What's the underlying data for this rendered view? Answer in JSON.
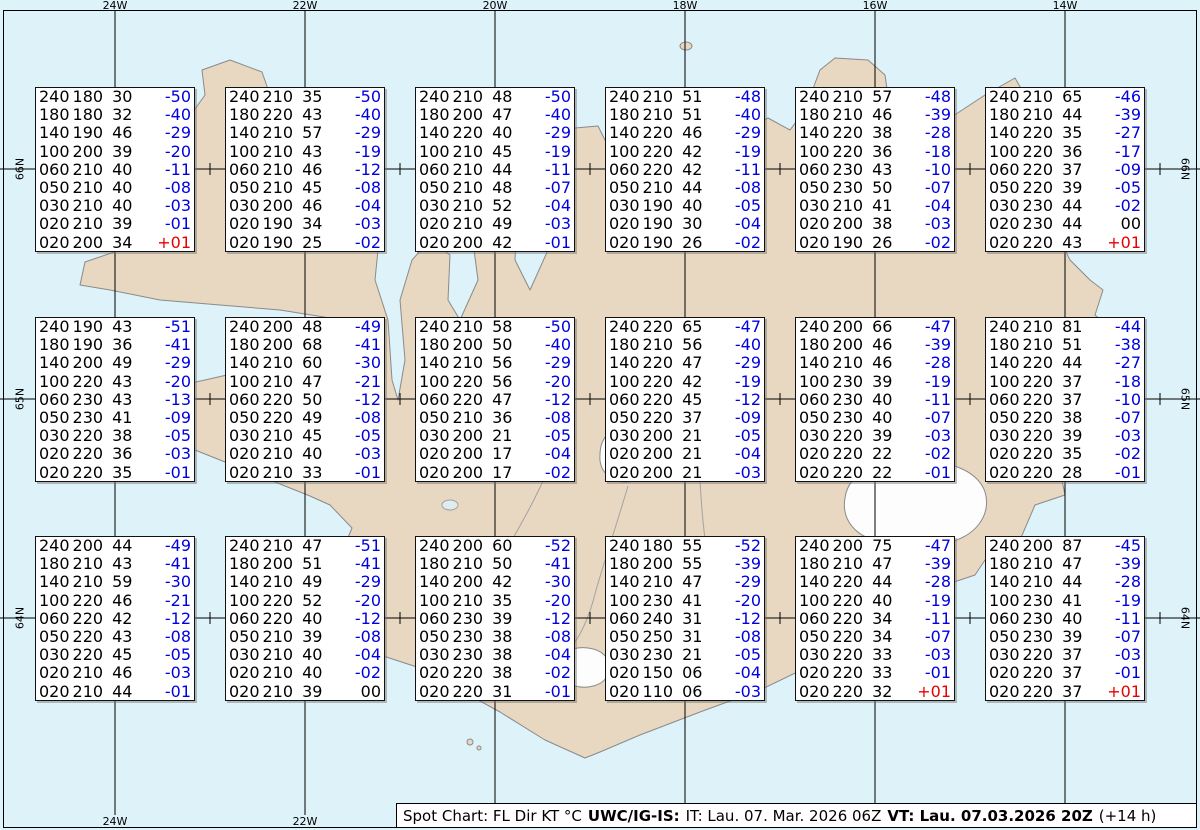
{
  "map": {
    "top_longitude_labels": [
      "24W",
      "22W",
      "20W",
      "18W",
      "16W",
      "14W"
    ],
    "bottom_longitude_labels": [
      "24W",
      "22W",
      "20W",
      "18W",
      "16W",
      "14W"
    ],
    "left_latitude_labels": [
      "66N",
      "65N",
      "64N"
    ],
    "right_latitude_labels": [
      "66N",
      "65N",
      "64N"
    ],
    "colors": {
      "ocean": "#ddf2f9",
      "land": "#e8d7c1",
      "coast": "#8a8a8a",
      "glacier": "#fdfdfd",
      "grid": "#000000"
    }
  },
  "temp_colors": {
    "negative": "#0000e0",
    "positive": "#e80000",
    "zero": "#000000"
  },
  "spot_boxes": [
    {
      "row": 0,
      "col": 0,
      "lines": [
        "240180 30 -50",
        "180180 32 -40",
        "140190 46 -29",
        "100200 39 -20",
        "060210 40 -11",
        "050210 40 -08",
        "030210 40 -03",
        "020210 39 -01",
        "020200 34 +01"
      ]
    },
    {
      "row": 0,
      "col": 1,
      "lines": [
        "240210 35 -50",
        "180220 43 -40",
        "140210 57 -29",
        "100210 43 -19",
        "060210 46 -12",
        "050210 45 -08",
        "030200 46 -04",
        "020190 34 -03",
        "020190 25 -02"
      ]
    },
    {
      "row": 0,
      "col": 2,
      "lines": [
        "240210 48 -50",
        "180200 47 -40",
        "140220 40 -29",
        "100210 45 -19",
        "060210 44 -11",
        "050210 48 -07",
        "030210 52 -04",
        "020210 49 -03",
        "020200 42 -01"
      ]
    },
    {
      "row": 0,
      "col": 3,
      "lines": [
        "240210 51 -48",
        "180210 51 -40",
        "140220 46 -29",
        "100220 42 -19",
        "060220 42 -11",
        "050210 44 -08",
        "030190 40 -05",
        "020190 30 -04",
        "020190 26 -02"
      ]
    },
    {
      "row": 0,
      "col": 4,
      "lines": [
        "240210 57 -48",
        "180210 46 -39",
        "140220 38 -28",
        "100220 36 -18",
        "060230 43 -10",
        "050230 50 -07",
        "030210 41 -04",
        "020200 38 -03",
        "020190 26 -02"
      ]
    },
    {
      "row": 0,
      "col": 5,
      "lines": [
        "240210 65 -46",
        "180210 44 -39",
        "140220 35 -27",
        "100220 36 -17",
        "060220 37 -09",
        "050220 39 -05",
        "030230 44 -02",
        "020230 44 00",
        "020220 43 +01"
      ]
    },
    {
      "row": 1,
      "col": 0,
      "lines": [
        "240190 43 -51",
        "180190 36 -41",
        "140200 49 -29",
        "100220 43 -20",
        "060230 43 -13",
        "050230 41 -09",
        "030220 38 -05",
        "020220 36 -03",
        "020220 35 -01"
      ]
    },
    {
      "row": 1,
      "col": 1,
      "lines": [
        "240200 48 -49",
        "180200 68 -41",
        "140210 60 -30",
        "100210 47 -21",
        "060220 50 -12",
        "050220 49 -08",
        "030210 45 -05",
        "020210 40 -03",
        "020210 33 -01"
      ]
    },
    {
      "row": 1,
      "col": 2,
      "lines": [
        "240210 58 -50",
        "180200 50 -40",
        "140210 56 -29",
        "100220 56 -20",
        "060220 47 -12",
        "050210 36 -08",
        "030200 21 -05",
        "020200 17 -04",
        "020200 17 -02"
      ]
    },
    {
      "row": 1,
      "col": 3,
      "lines": [
        "240220 65 -47",
        "180210 56 -40",
        "140220 47 -29",
        "100220 42 -19",
        "060220 45 -12",
        "050220 37 -09",
        "030200 21 -05",
        "020200 21 -04",
        "020200 21 -03"
      ]
    },
    {
      "row": 1,
      "col": 4,
      "lines": [
        "240200 66 -47",
        "180200 46 -39",
        "140210 46 -28",
        "100230 39 -19",
        "060230 40 -11",
        "050230 40 -07",
        "030220 39 -03",
        "020220 22 -02",
        "020220 22 -01"
      ]
    },
    {
      "row": 1,
      "col": 5,
      "lines": [
        "240210 81 -44",
        "180210 51 -38",
        "140220 44 -27",
        "100220 37 -18",
        "060220 37 -10",
        "050220 38 -07",
        "030220 39 -03",
        "020220 35 -02",
        "020220 28 -01"
      ]
    },
    {
      "row": 2,
      "col": 0,
      "lines": [
        "240200 44 -49",
        "180210 43 -41",
        "140210 59 -30",
        "100220 46 -21",
        "060220 42 -12",
        "050220 43 -08",
        "030220 45 -05",
        "020210 46 -03",
        "020210 44 -01"
      ]
    },
    {
      "row": 2,
      "col": 1,
      "lines": [
        "240210 47 -51",
        "180200 51 -41",
        "140210 49 -29",
        "100220 52 -20",
        "060220 40 -12",
        "050210 39 -08",
        "030210 40 -04",
        "020210 40 -02",
        "020210 39 00"
      ]
    },
    {
      "row": 2,
      "col": 2,
      "lines": [
        "240200 60 -52",
        "180210 50 -41",
        "140200 42 -30",
        "100210 35 -20",
        "060230 39 -12",
        "050230 38 -08",
        "030230 38 -04",
        "020220 38 -02",
        "020220 31 -01"
      ]
    },
    {
      "row": 2,
      "col": 3,
      "lines": [
        "240180 55 -52",
        "180200 55 -39",
        "140210 47 -29",
        "100230 41 -20",
        "060240 31 -12",
        "050250 31 -08",
        "030230 21 -05",
        "020150 06 -04",
        "020110 06 -03"
      ]
    },
    {
      "row": 2,
      "col": 4,
      "lines": [
        "240200 75 -47",
        "180210 47 -39",
        "140220 44 -28",
        "100220 40 -19",
        "060220 34 -11",
        "050220 34 -07",
        "030220 33 -03",
        "020220 33 -01",
        "020220 32 +01"
      ]
    },
    {
      "row": 2,
      "col": 5,
      "lines": [
        "240200 87 -45",
        "180210 47 -39",
        "140210 44 -28",
        "100230 41 -19",
        "060230 40 -11",
        "050230 39 -07",
        "030220 37 -03",
        "020220 37 -01",
        "020220 37 +01"
      ]
    }
  ],
  "footer": {
    "chart_type": "Spot Chart: FL Dir KT °C",
    "source": "UWC/IG-IS:",
    "issue_time": "IT: Lau. 07. Mar. 2026 06Z",
    "valid_time": "VT: Lau. 07.03.2026 20Z",
    "offset": "(+14 h)"
  }
}
